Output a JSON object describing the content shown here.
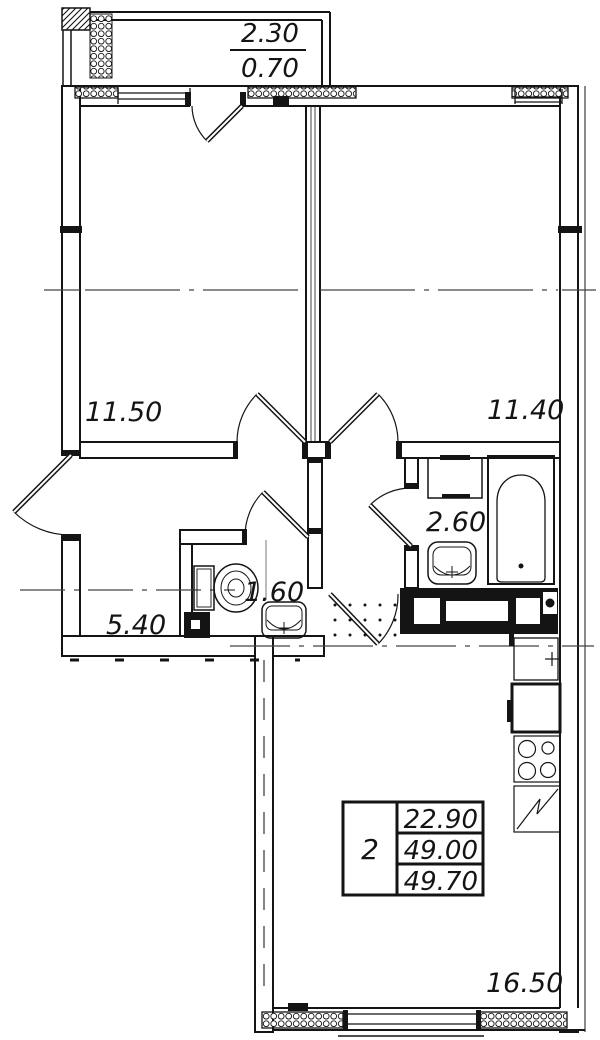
{
  "plan": {
    "balcony": {
      "area_upper": "2.30",
      "area_lower": "0.70"
    },
    "rooms": {
      "room_left": "11.50",
      "room_right": "11.40",
      "bathroom": "2.60",
      "wc": "1.60",
      "hallway": "5.40",
      "kitchen_living": "16.50"
    },
    "stamp": {
      "rooms_count": "2",
      "living_area": "22.90",
      "floor_area": "49.00",
      "total_area": "49.70"
    }
  },
  "colors": {
    "line": "#141414",
    "background": "#ffffff"
  }
}
